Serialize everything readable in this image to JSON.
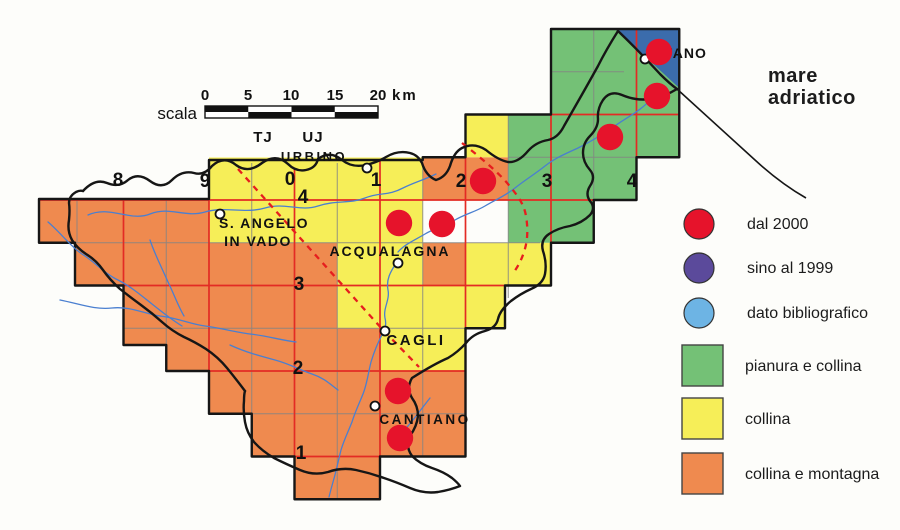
{
  "scale": {
    "label": "scala",
    "ticks": [
      "0",
      "5",
      "10",
      "15",
      "20"
    ],
    "unit": "km"
  },
  "utm_zones": {
    "left": "TJ",
    "right": "UJ"
  },
  "grid": {
    "column_labels": [
      "8",
      "9",
      "0",
      "1",
      "2",
      "3",
      "4"
    ],
    "row_labels": [
      "4",
      "3",
      "2",
      "1"
    ]
  },
  "sea": {
    "line1": "mare",
    "line2": "adriatico"
  },
  "towns": [
    {
      "label": "URBINO"
    },
    {
      "label": "S. ANGELO",
      "label2": "IN VADO"
    },
    {
      "label": "ACQUALAGNA"
    },
    {
      "label": "CAGLI"
    },
    {
      "label": "CANTIANO"
    },
    {
      "label": "FANO"
    }
  ],
  "legend": {
    "points": [
      {
        "label": "dal 2000",
        "color": "#e6132b"
      },
      {
        "label": "sino al 1999",
        "color": "#5b4a9b"
      },
      {
        "label": "dato bibliografico",
        "color": "#6db4e4"
      }
    ],
    "areas": [
      {
        "label": "pianura e collina",
        "color": "#74c176"
      },
      {
        "label": "collina",
        "color": "#f6ee58"
      },
      {
        "label": "collina e montagna",
        "color": "#ef8a4f"
      }
    ]
  },
  "occurrences": {
    "category": "dal 2000",
    "points": [
      [
        659,
        52
      ],
      [
        657,
        96
      ],
      [
        610,
        137
      ],
      [
        483,
        181
      ],
      [
        399,
        223
      ],
      [
        442,
        224
      ],
      [
        398,
        391
      ],
      [
        400,
        438
      ]
    ]
  },
  "colors": {
    "sea": "#3b6cac",
    "grid_red": "#e32b24",
    "grid_gray": "#848484",
    "boundary": "#161616",
    "river": "#4a7fd0",
    "dashed_line": "#e61e1e",
    "paper": "#fdfdfa"
  }
}
